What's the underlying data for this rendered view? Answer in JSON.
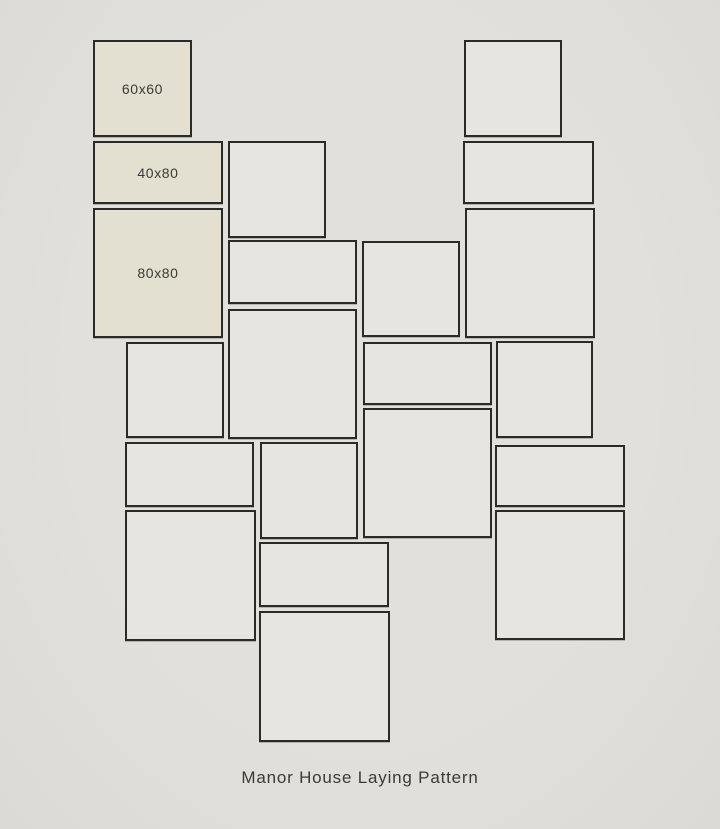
{
  "title": "Manor House Laying Pattern",
  "tile_sizes": [
    "60x60",
    "40x80",
    "80x80"
  ],
  "colors": {
    "background": "#e2e0dc",
    "tile_fill": "#e6e5e1",
    "labeled_tile_fill": "#e3e0d2",
    "border": "#2b2b26",
    "text": "#3b3a35"
  },
  "tiles": [
    {
      "x": 93,
      "y": 40,
      "w": 99,
      "h": 97,
      "label": "60x60"
    },
    {
      "x": 93,
      "y": 141,
      "w": 130,
      "h": 63,
      "label": "40x80"
    },
    {
      "x": 93,
      "y": 208,
      "w": 130,
      "h": 130,
      "label": "80x80"
    },
    {
      "x": 228,
      "y": 141,
      "w": 98,
      "h": 97,
      "label": ""
    },
    {
      "x": 464,
      "y": 40,
      "w": 98,
      "h": 97,
      "label": ""
    },
    {
      "x": 463,
      "y": 141,
      "w": 131,
      "h": 63,
      "label": ""
    },
    {
      "x": 465,
      "y": 208,
      "w": 130,
      "h": 130,
      "label": ""
    },
    {
      "x": 228,
      "y": 240,
      "w": 129,
      "h": 64,
      "label": ""
    },
    {
      "x": 362,
      "y": 241,
      "w": 98,
      "h": 96,
      "label": ""
    },
    {
      "x": 228,
      "y": 309,
      "w": 129,
      "h": 130,
      "label": ""
    },
    {
      "x": 126,
      "y": 342,
      "w": 98,
      "h": 96,
      "label": ""
    },
    {
      "x": 363,
      "y": 342,
      "w": 129,
      "h": 63,
      "label": ""
    },
    {
      "x": 496,
      "y": 341,
      "w": 97,
      "h": 97,
      "label": ""
    },
    {
      "x": 125,
      "y": 442,
      "w": 129,
      "h": 65,
      "label": ""
    },
    {
      "x": 260,
      "y": 442,
      "w": 98,
      "h": 97,
      "label": ""
    },
    {
      "x": 363,
      "y": 408,
      "w": 129,
      "h": 130,
      "label": ""
    },
    {
      "x": 495,
      "y": 445,
      "w": 130,
      "h": 62,
      "label": ""
    },
    {
      "x": 125,
      "y": 510,
      "w": 131,
      "h": 131,
      "label": ""
    },
    {
      "x": 259,
      "y": 542,
      "w": 130,
      "h": 65,
      "label": ""
    },
    {
      "x": 495,
      "y": 510,
      "w": 130,
      "h": 130,
      "label": ""
    },
    {
      "x": 259,
      "y": 611,
      "w": 131,
      "h": 131,
      "label": ""
    }
  ]
}
